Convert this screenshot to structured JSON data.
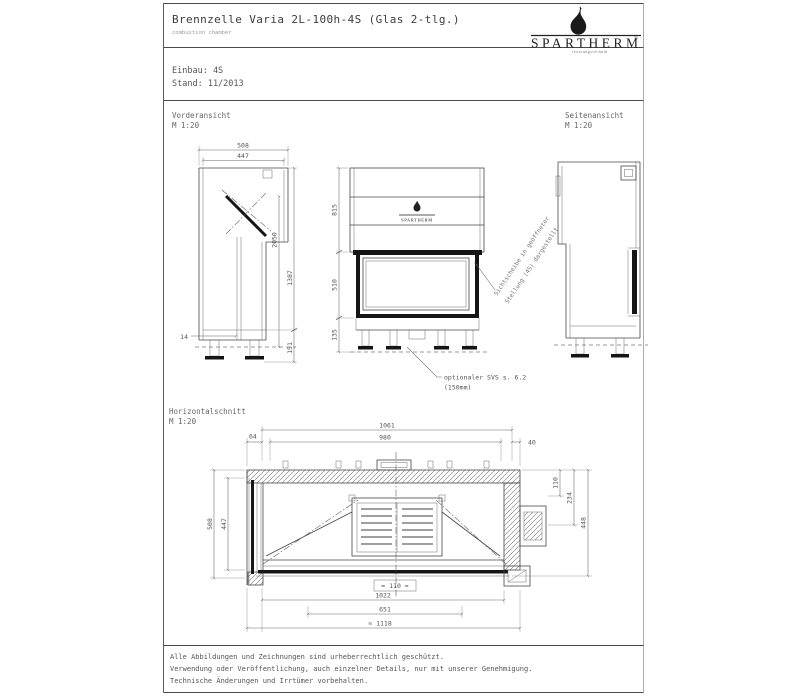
{
  "colors": {
    "line": "#474747",
    "bold": "#151515",
    "dim_text": "#555555",
    "background": "#ffffff"
  },
  "header": {
    "title": "Brennzelle Varia 2L-100h-4S (Glas 2-tlg.)",
    "subtitle": "combustion chamber",
    "einbau": "Einbau: 4S",
    "stand": "Stand: 11/2013"
  },
  "logo": {
    "brand": "SPARTHERM",
    "registered": "®",
    "tagline": "feuerungstechnik",
    "mini_brand": "SPARTHERM"
  },
  "views": {
    "front": {
      "name": "Vorderansicht",
      "scale": "M 1:20"
    },
    "side": {
      "name": "Seitenansicht",
      "scale": "M 1:20"
    },
    "plan": {
      "name": "Horizontalschnitt",
      "scale": "M 1:20"
    }
  },
  "dims": {
    "side_view": {
      "depth_outer": "508",
      "depth_inner": "447",
      "wall": "14",
      "inner_height": "2050",
      "total_height": "1387",
      "foot_height": "151"
    },
    "front_view": {
      "upper": "815",
      "glass": "510",
      "base": "135"
    },
    "plan_view": {
      "width_outer": "1061",
      "width_inner": "980",
      "offset_left": "64",
      "offset_right": "40",
      "depth_outer": "508",
      "depth_inner": "447",
      "right_a": "110",
      "right_b": "234",
      "right_c": "448",
      "bottom_a": "1022",
      "bottom_b": "651",
      "bottom_c": "≈ 1118",
      "front_center": "≈ 110 ≈"
    }
  },
  "notes": {
    "glass_line1": "Sichtscheibe in geöffneter",
    "glass_line2": "Stellung (4S) dargestellt",
    "svs_line1": "optionaler SVS s. 6.2",
    "svs_line2": "(150mm)"
  },
  "footer": {
    "line1": "Alle Abbildungen und Zeichnungen sind urheberrechtlich geschützt.",
    "line2": "Verwendung oder Veröffentlichung, auch einzelner Details, nur mit unserer Genehmigung.",
    "line3": "Technische Änderungen und Irrtümer vorbehalten."
  }
}
